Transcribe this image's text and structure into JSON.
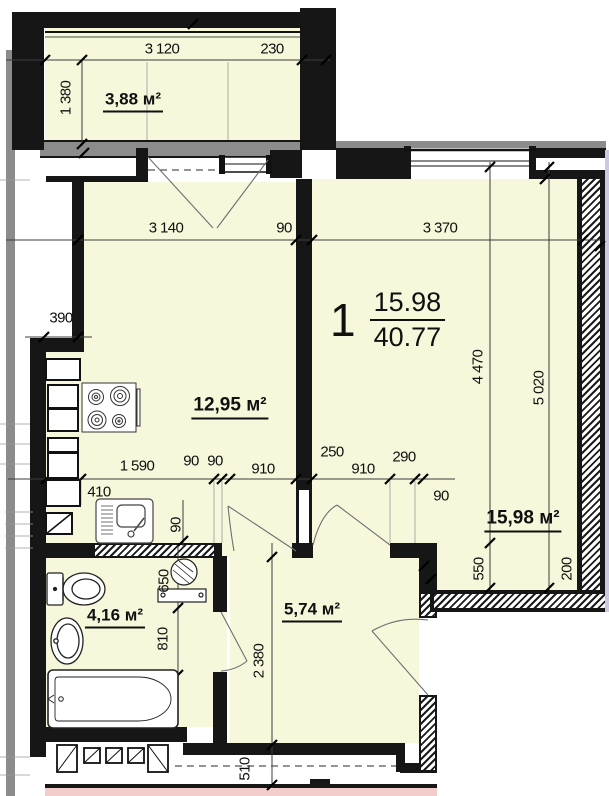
{
  "plan_title": "apartment-floor-plan",
  "unit": {
    "number": "1",
    "living_area": "15.98",
    "total_area": "40.77"
  },
  "areas": {
    "balcony": "3,88 м²",
    "kitchen": "12,95 м²",
    "living": "15,98 м²",
    "bathroom": "4,16 м²",
    "hallway": "5,74 м²"
  },
  "dims": {
    "balcony_width": "3 120",
    "balcony_end": "230",
    "balcony_depth": "1 380",
    "kitchen_width": "3 140",
    "wall_gap_90": "90",
    "room_width": "3 370",
    "niche_390": "390",
    "room_depth": "4 470",
    "room_depth_full": "5 020",
    "counter_1590": "1 590",
    "jamb_90_a": "90",
    "jamb_90_b": "90",
    "door_kitchen_910": "910",
    "wall_250": "250",
    "door_room_910": "910",
    "jamb_290": "290",
    "jamb_90_right": "90",
    "counter_410": "410",
    "jamb_90_mid": "90",
    "bath_650": "650",
    "bath_810": "810",
    "hall_depth_2380": "2 380",
    "hall_bottom_510": "510",
    "room_550": "550",
    "wall_200": "200"
  },
  "colors": {
    "room_fill": "#f7f7dc",
    "wall": "#161616",
    "gray_wall": "#8c8c8c",
    "adjacent_pink": "#f3cdcb",
    "adjacent_purple": "#cfc7e2"
  }
}
